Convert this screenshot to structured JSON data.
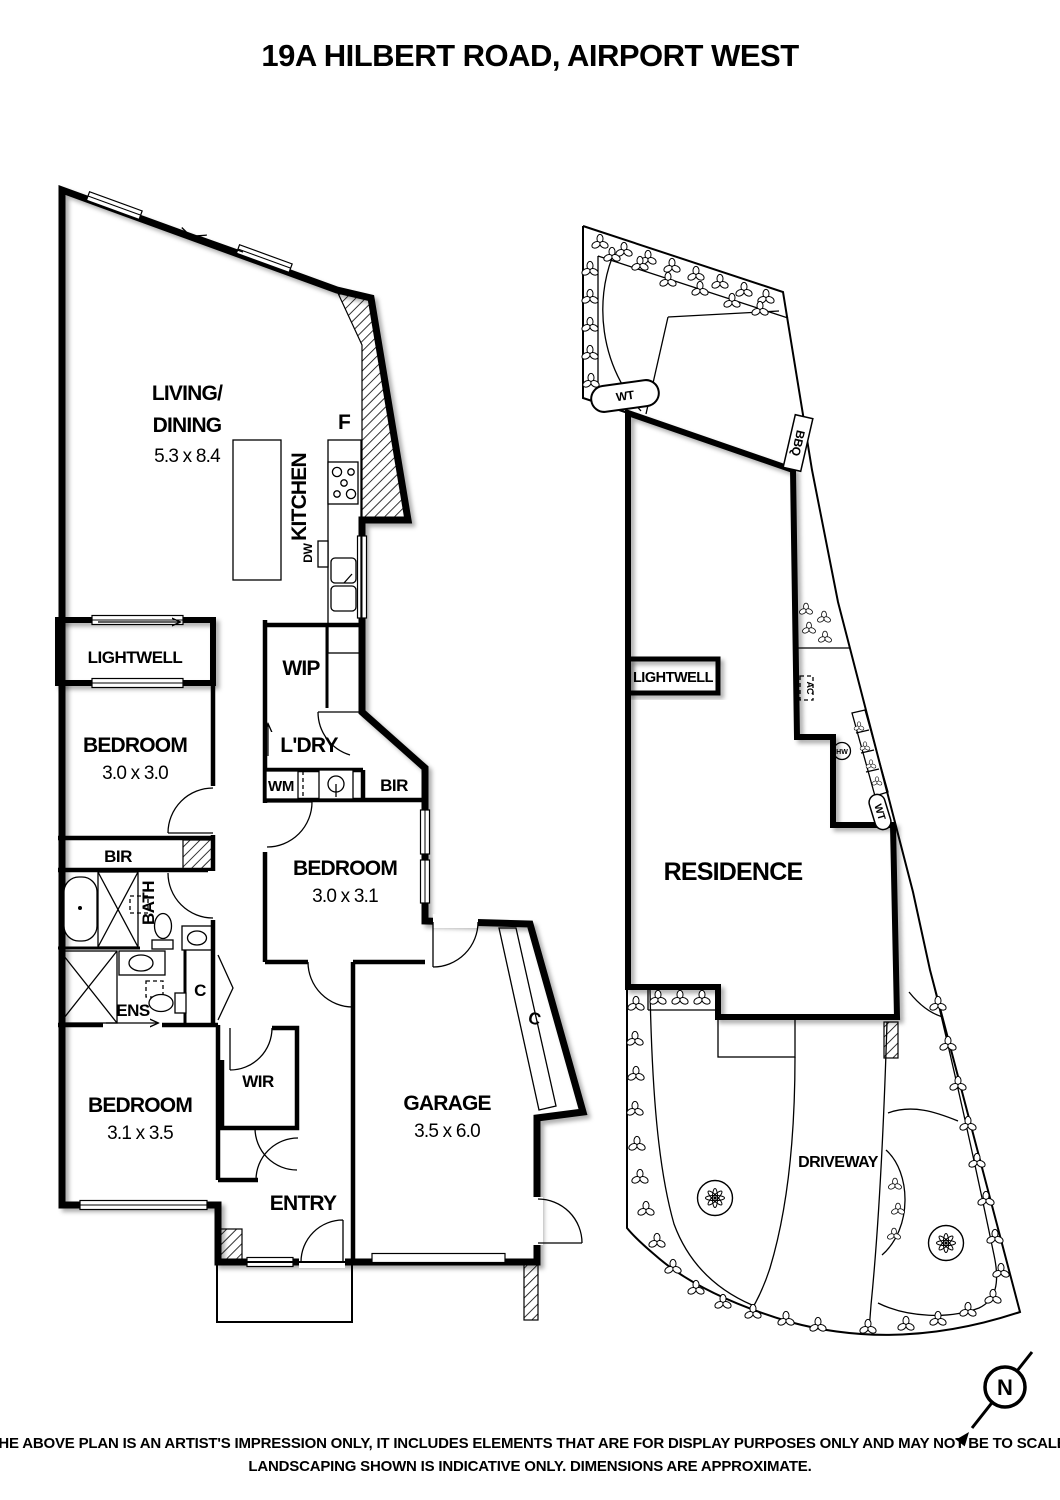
{
  "title": "19A HILBERT ROAD, AIRPORT WEST",
  "unit_plan": {
    "living": {
      "line1": "LIVING/",
      "line2": "DINING",
      "dims": "5.3 x 8.4"
    },
    "kitchen": {
      "label": "KITCHEN",
      "fridge_label": "F",
      "dishwasher_label": "DW"
    },
    "lightwell": {
      "label": "LIGHTWELL"
    },
    "wip": {
      "label": "WIP"
    },
    "laundry": {
      "label": "L'DRY",
      "wm_label": "WM"
    },
    "bir_bedroom1": {
      "label": "BIR"
    },
    "bir_hall": {
      "label": "BIR"
    },
    "bath": {
      "label": "BATH"
    },
    "ens": {
      "label": "ENS"
    },
    "hall_cupboard": {
      "label": "C"
    },
    "bedroom1": {
      "label": "BEDROOM",
      "dims": "3.0 x 3.0"
    },
    "bedroom2": {
      "label": "BEDROOM",
      "dims": "3.0 x 3.1"
    },
    "bedroom3": {
      "label": "BEDROOM",
      "dims": "3.1 x 3.5"
    },
    "wir": {
      "label": "WIR"
    },
    "entry": {
      "label": "ENTRY"
    },
    "garage": {
      "label": "GARAGE",
      "dims": "3.5 x 6.0",
      "cupboard_label": "C"
    }
  },
  "site_plan": {
    "residence_label": "RESIDENCE",
    "lightwell_label": "LIGHTWELL",
    "driveway_label": "DRIVEWAY",
    "bbq_label": "BBQ",
    "wt_rear_label": "WT",
    "wt_side_label": "WT",
    "ac_label": "AC",
    "hw_label": "HW"
  },
  "compass": {
    "north_label": "N"
  },
  "disclaimer": {
    "line1": "THE ABOVE PLAN IS AN ARTIST'S IMPRESSION ONLY, IT INCLUDES ELEMENTS THAT ARE FOR DISPLAY PURPOSES ONLY AND MAY NOT BE TO SCALE.",
    "line2": "LANDSCAPING SHOWN IS INDICATIVE ONLY. DIMENSIONS ARE APPROXIMATE."
  },
  "colors": {
    "ink": "#000000",
    "paper": "#ffffff"
  }
}
